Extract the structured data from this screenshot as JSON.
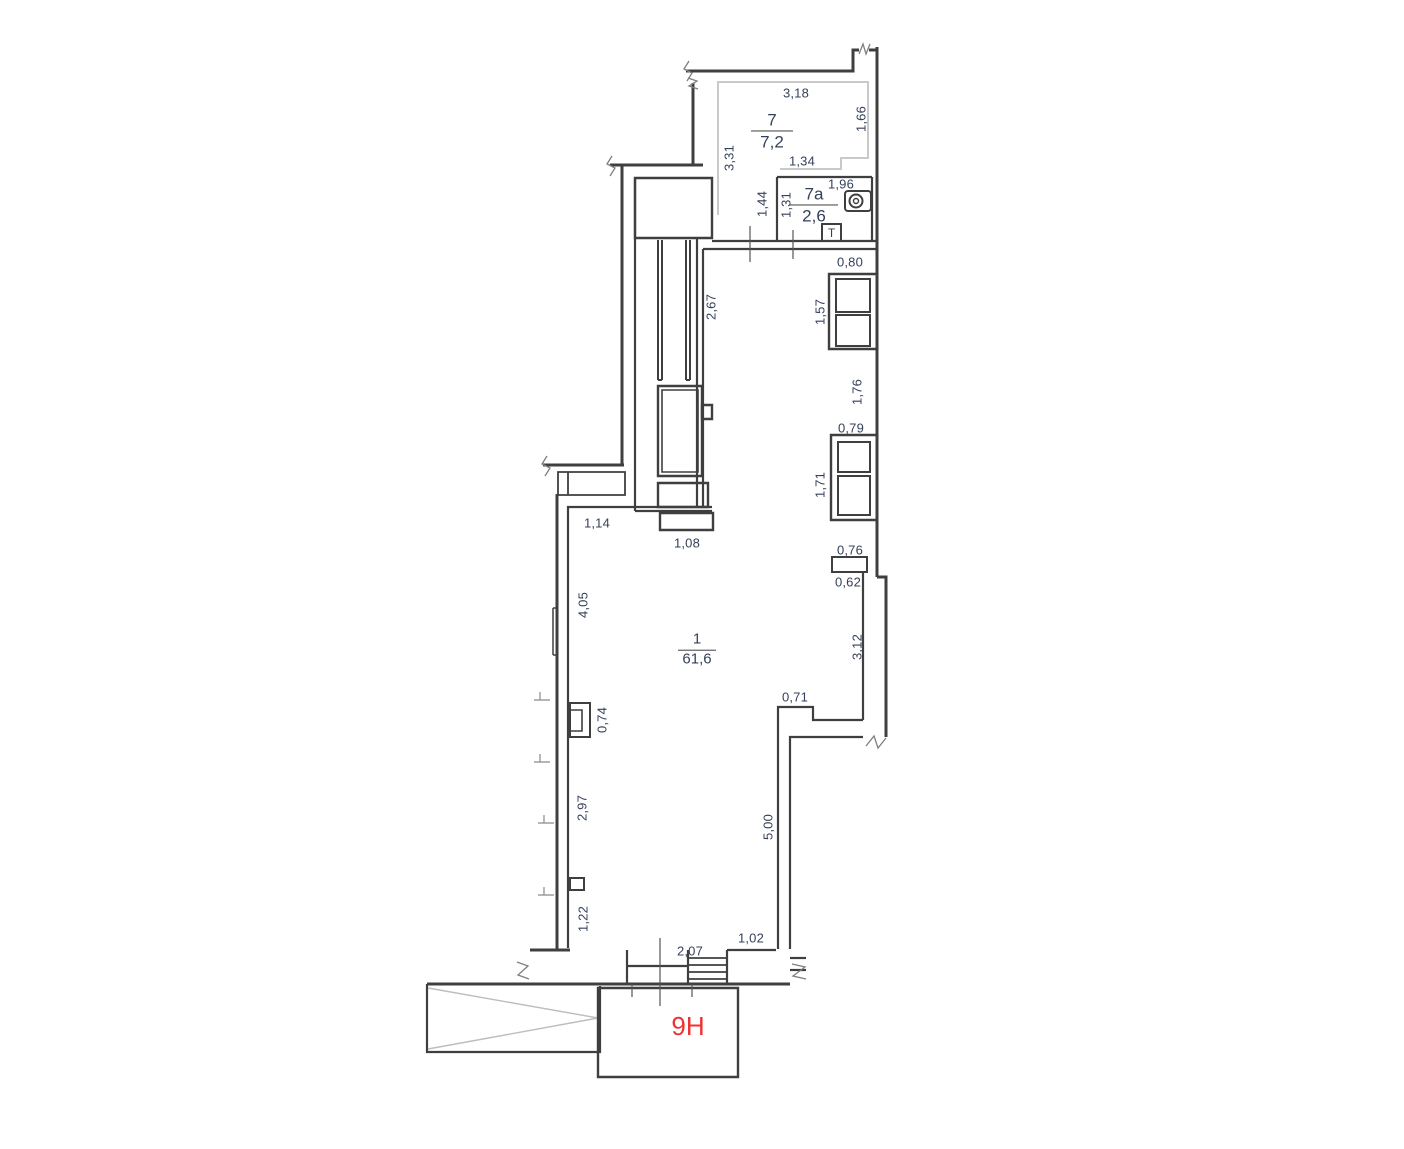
{
  "drawing": {
    "type": "floor-plan",
    "unit_label": "9H",
    "towel_marker": "T"
  },
  "colors": {
    "background": "#ffffff",
    "wall": "#3f3f3f",
    "light_wall": "#c9c9c9",
    "hatch": "#bdbdbd",
    "dimension_text": "#35415a",
    "unit_label_red": "#f23030"
  },
  "rooms": [
    {
      "id": "room-7",
      "number": "7",
      "area": "7,2"
    },
    {
      "id": "room-7a",
      "number": "7a",
      "area": "2,6"
    },
    {
      "id": "room-1",
      "number": "1",
      "area": "61,6"
    }
  ],
  "dimensions": [
    {
      "text": "3,18",
      "x": 796,
      "y": 93,
      "o": "h"
    },
    {
      "text": "1,66",
      "x": 861,
      "y": 119,
      "o": "v"
    },
    {
      "text": "3,31",
      "x": 729,
      "y": 158,
      "o": "v"
    },
    {
      "text": "1,34",
      "x": 802,
      "y": 161,
      "o": "h"
    },
    {
      "text": "1,44",
      "x": 762,
      "y": 204,
      "o": "v"
    },
    {
      "text": "1,31",
      "x": 786,
      "y": 205,
      "o": "v"
    },
    {
      "text": "1,96",
      "x": 841,
      "y": 184,
      "o": "h"
    },
    {
      "text": "2,67",
      "x": 711,
      "y": 307,
      "o": "v"
    },
    {
      "text": "0,80",
      "x": 850,
      "y": 262,
      "o": "h"
    },
    {
      "text": "1,57",
      "x": 820,
      "y": 312,
      "o": "v"
    },
    {
      "text": "1,76",
      "x": 857,
      "y": 392,
      "o": "v"
    },
    {
      "text": "0,79",
      "x": 851,
      "y": 428,
      "o": "h"
    },
    {
      "text": "1,71",
      "x": 820,
      "y": 485,
      "o": "v"
    },
    {
      "text": "0,76",
      "x": 850,
      "y": 550,
      "o": "h"
    },
    {
      "text": "0,62",
      "x": 848,
      "y": 582,
      "o": "h"
    },
    {
      "text": "1,14",
      "x": 597,
      "y": 523,
      "o": "h"
    },
    {
      "text": "1,08",
      "x": 687,
      "y": 543,
      "o": "h"
    },
    {
      "text": "4,05",
      "x": 583,
      "y": 605,
      "o": "v"
    },
    {
      "text": "0,74",
      "x": 602,
      "y": 720,
      "o": "v"
    },
    {
      "text": "3,12",
      "x": 857,
      "y": 647,
      "o": "v"
    },
    {
      "text": "0,71",
      "x": 795,
      "y": 697,
      "o": "h"
    },
    {
      "text": "2,97",
      "x": 582,
      "y": 808,
      "o": "v"
    },
    {
      "text": "5,00",
      "x": 768,
      "y": 827,
      "o": "v"
    },
    {
      "text": "1,22",
      "x": 583,
      "y": 919,
      "o": "v"
    },
    {
      "text": "2,07",
      "x": 690,
      "y": 951,
      "o": "h"
    },
    {
      "text": "1,02",
      "x": 751,
      "y": 938,
      "o": "h"
    }
  ]
}
